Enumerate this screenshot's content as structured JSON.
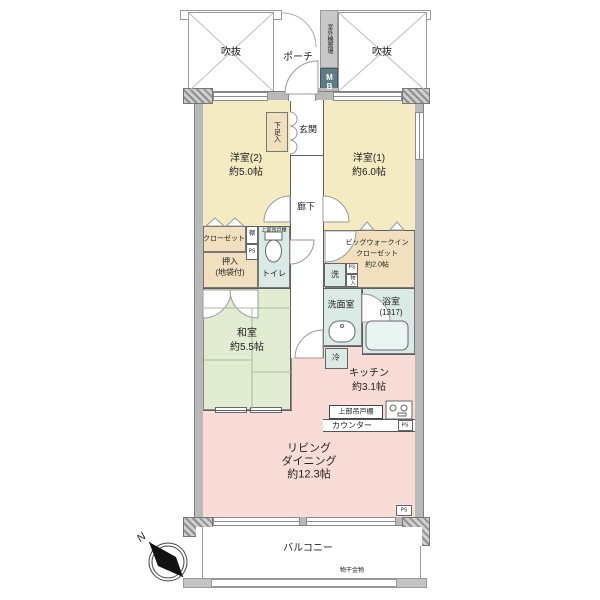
{
  "top": {
    "void_left": "吹抜",
    "void_right": "吹抜",
    "porch": "ポーチ",
    "outdoor_unit": "室外機置場",
    "meter_box": "MB"
  },
  "rooms": {
    "western2": {
      "name": "洋室(2)",
      "size": "約5.0帖"
    },
    "western1": {
      "name": "洋室(1)",
      "size": "約6.0帖"
    },
    "entrance": "玄関",
    "shoebox": "下足入",
    "hallway": "廊下",
    "closet": "クローゼット",
    "shelf": "棚",
    "toilet_upper_shelf": "上部吊戸棚",
    "toilet": "トイレ",
    "oshiire": {
      "line1": "押入",
      "line2": "(地袋付)"
    },
    "washitsu": {
      "name": "和室",
      "size": "約5.5帖"
    },
    "wic": {
      "line1": "ビッグウォークイン",
      "line2": "クローゼット",
      "line3": "約2.0帖"
    },
    "washer": "洗",
    "storage_small": "物入",
    "washroom": "洗面室",
    "bathroom": {
      "name": "浴室",
      "size": "(1317)"
    },
    "fridge": "冷",
    "kitchen": {
      "name": "キッチン",
      "size": "約3.1帖"
    },
    "kitchen_upper_cabinet": "上部吊戸棚",
    "counter": "カウンター",
    "living": {
      "line1": "リビング",
      "line2": "ダイニング",
      "line3": "約12.3帖"
    },
    "balcony": "バルコニー",
    "laundry_fitting": "物干金物"
  },
  "ps": {
    "p1": "PS",
    "p2": "PS",
    "p3": "PS",
    "p4": "PS"
  },
  "compass": {
    "north": "N"
  },
  "colors": {
    "bedroom": "#f4ebc3",
    "storage_tan": "#f1dfbe",
    "wet_teal": "#d9ebe4",
    "tatami_green": "#e1ecd2",
    "living_pink": "#f8dcd5",
    "wall_gray": "#b9b9b9",
    "meter_box": "#5c7c86"
  }
}
